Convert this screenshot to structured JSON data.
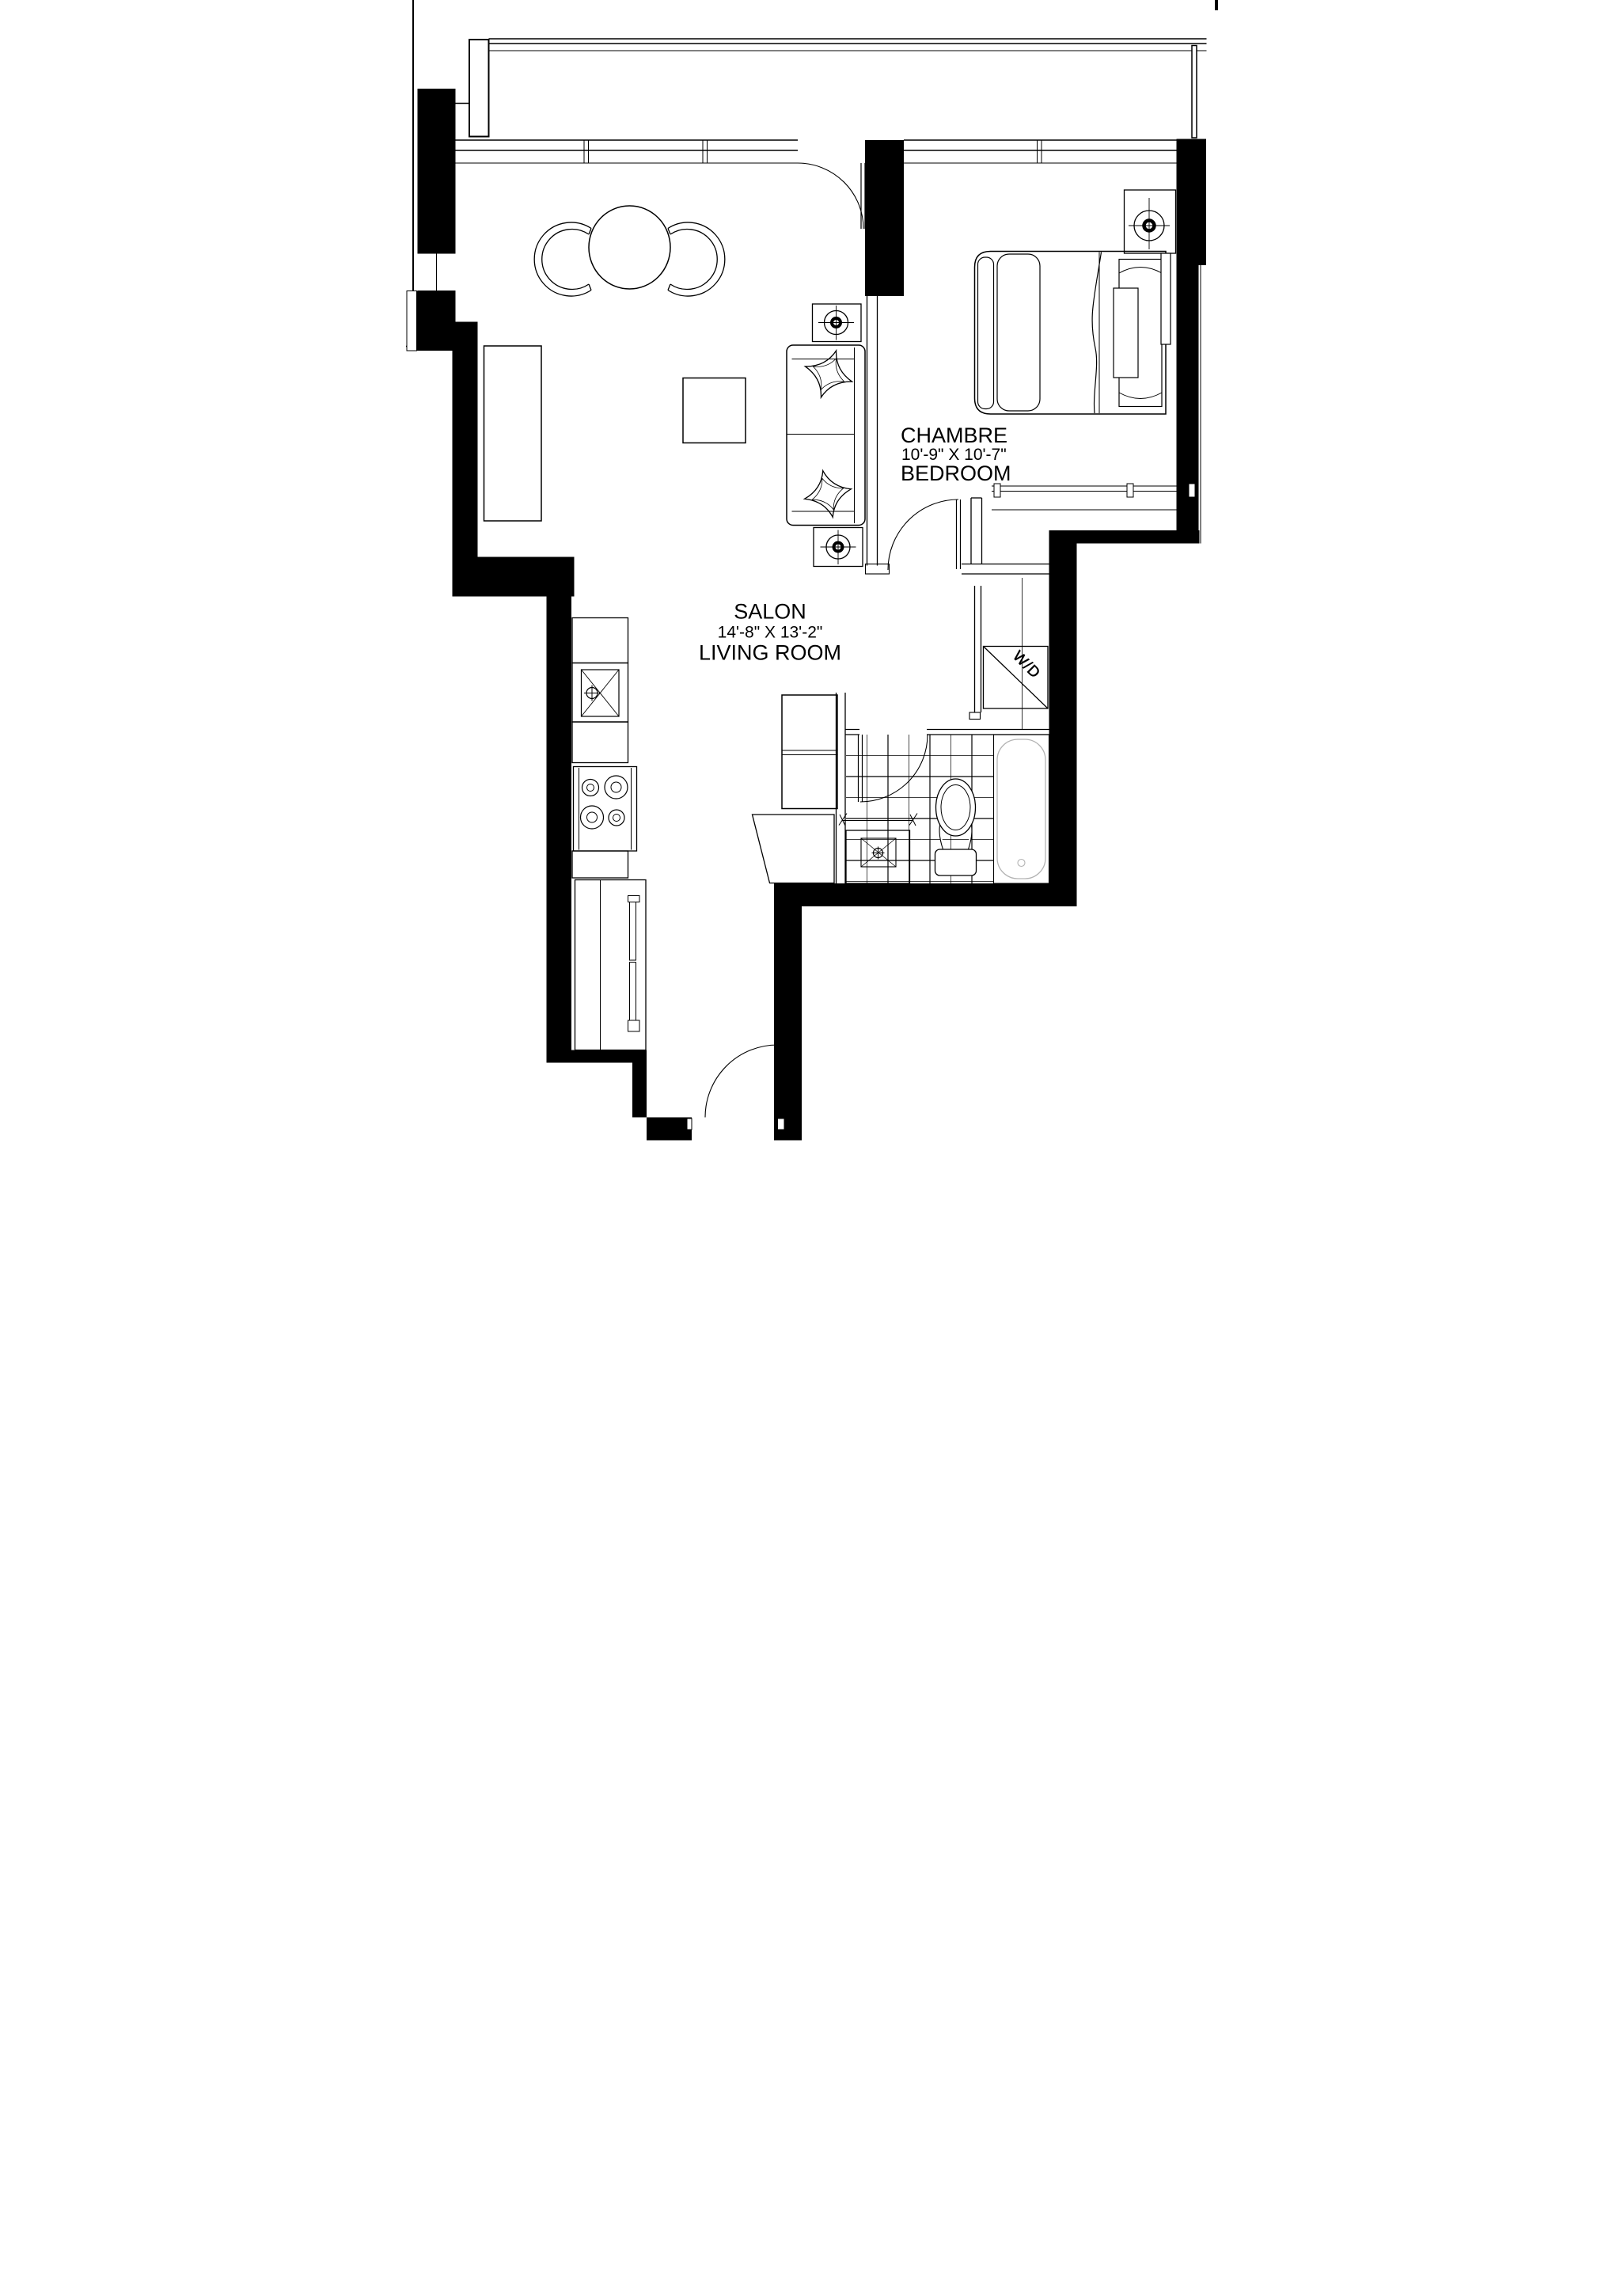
{
  "document": {
    "type": "residential condo unit floor plan",
    "style": "black-and-white architectural drawing",
    "language": "bilingual French/English"
  },
  "rooms": {
    "bedroom": {
      "label_fr": "CHAMBRE",
      "dimensions": "10'-9\" X 10'-7\"",
      "label_en": "BEDROOM"
    },
    "living_room": {
      "label_fr": "SALON",
      "dimensions": "14'-8\" X 13'-2\"",
      "label_en": "LIVING ROOM"
    },
    "laundry": {
      "label": "W/D"
    }
  },
  "colors": {
    "walls": "#000000",
    "lines": "#000000",
    "background": "#ffffff",
    "tub_outline": "#b3b3b3"
  },
  "fixtures": [
    "balcony-railing",
    "balcony-column",
    "window-band",
    "dining-table",
    "dining-chairs",
    "tv-console",
    "coffee-table",
    "sofa",
    "throw-pillows",
    "ceiling-light-symbols",
    "double-bed",
    "pillows",
    "foot-bench",
    "closet-shelf",
    "kitchen-counter",
    "kitchen-sink",
    "cooktop-4-burners",
    "pantry-sliding-doors",
    "washer-dryer-closet",
    "bathroom-tile-floor",
    "bathtub",
    "toilet",
    "vanity-sink",
    "entry-door-swing",
    "bedroom-door-swing",
    "bathroom-door-swing",
    "balcony-door-swing"
  ]
}
